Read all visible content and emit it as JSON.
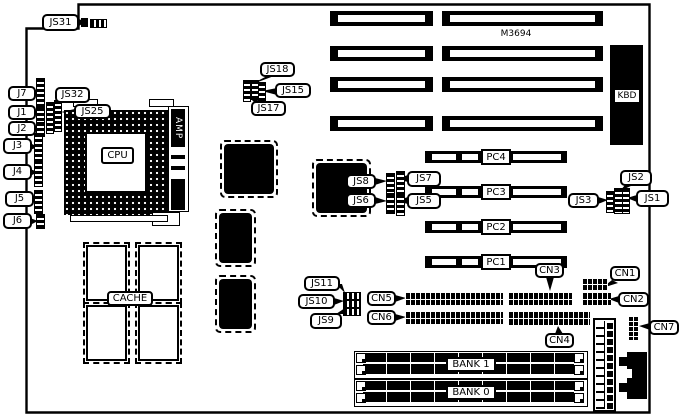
{
  "model": {
    "text": "M3694"
  },
  "cpu": {
    "socket_label": "CPU",
    "amp": "AMP"
  },
  "cache": {
    "label": "CACHE"
  },
  "kbd": {
    "label": "KBD"
  },
  "banks": {
    "bank1": "BANK 1",
    "bank0": "BANK 0"
  },
  "pci": {
    "pc1": "PC1",
    "pc2": "PC2",
    "pc3": "PC3",
    "pc4": "PC4"
  },
  "jumpers": {
    "js1": "JS1",
    "js2": "JS2",
    "js3": "JS3",
    "js5": "JS5",
    "js6": "JS6",
    "js7": "JS7",
    "js8": "JS8",
    "js9": "JS9",
    "js10": "JS10",
    "js11": "JS11",
    "js15": "JS15",
    "js17": "JS17",
    "js18": "JS18",
    "js25": "JS25",
    "js31": "JS31",
    "js32": "JS32"
  },
  "connectors": {
    "cn1": "CN1",
    "cn2": "CN2",
    "cn3": "CN3",
    "cn4": "CN4",
    "cn5": "CN5",
    "cn6": "CN6",
    "cn7": "CN7"
  },
  "edge": {
    "j1": "J1",
    "j2": "J2",
    "j3": "J3",
    "j4": "J4",
    "j5": "J5",
    "j6": "J6",
    "j7": "J7"
  },
  "colors": {
    "line": "#000000",
    "bg": "#ffffff"
  }
}
